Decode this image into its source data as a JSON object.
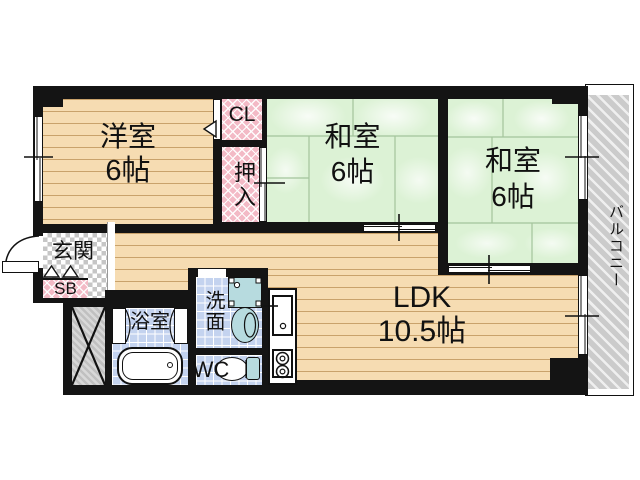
{
  "rooms": {
    "western_room": {
      "label": "洋室",
      "size": "6帖"
    },
    "japanese_room_center": {
      "label": "和室",
      "size": "6帖"
    },
    "japanese_room_right": {
      "label": "和室",
      "size": "6帖"
    },
    "ldk": {
      "label": "LDK",
      "size": "10.5帖"
    },
    "closet": {
      "label": "CL"
    },
    "futon_closet": {
      "label": "押入"
    },
    "entrance": {
      "label": "玄関"
    },
    "shoe_box": {
      "label": "SB"
    },
    "bathroom": {
      "label": "浴室"
    },
    "washroom": {
      "label": "洗面"
    },
    "toilet": {
      "label": "WC"
    },
    "balcony": {
      "label": "バルコニー"
    }
  },
  "colors": {
    "wall": "#141414",
    "wood": "#f6dcb2",
    "wood_line": "#c9a26b",
    "tatami": "#dcf2d5",
    "pink": "#f3bac6",
    "tile": "#c4d3ef",
    "teal": "#b7dbdf",
    "balcony": "#cbcbcb"
  }
}
